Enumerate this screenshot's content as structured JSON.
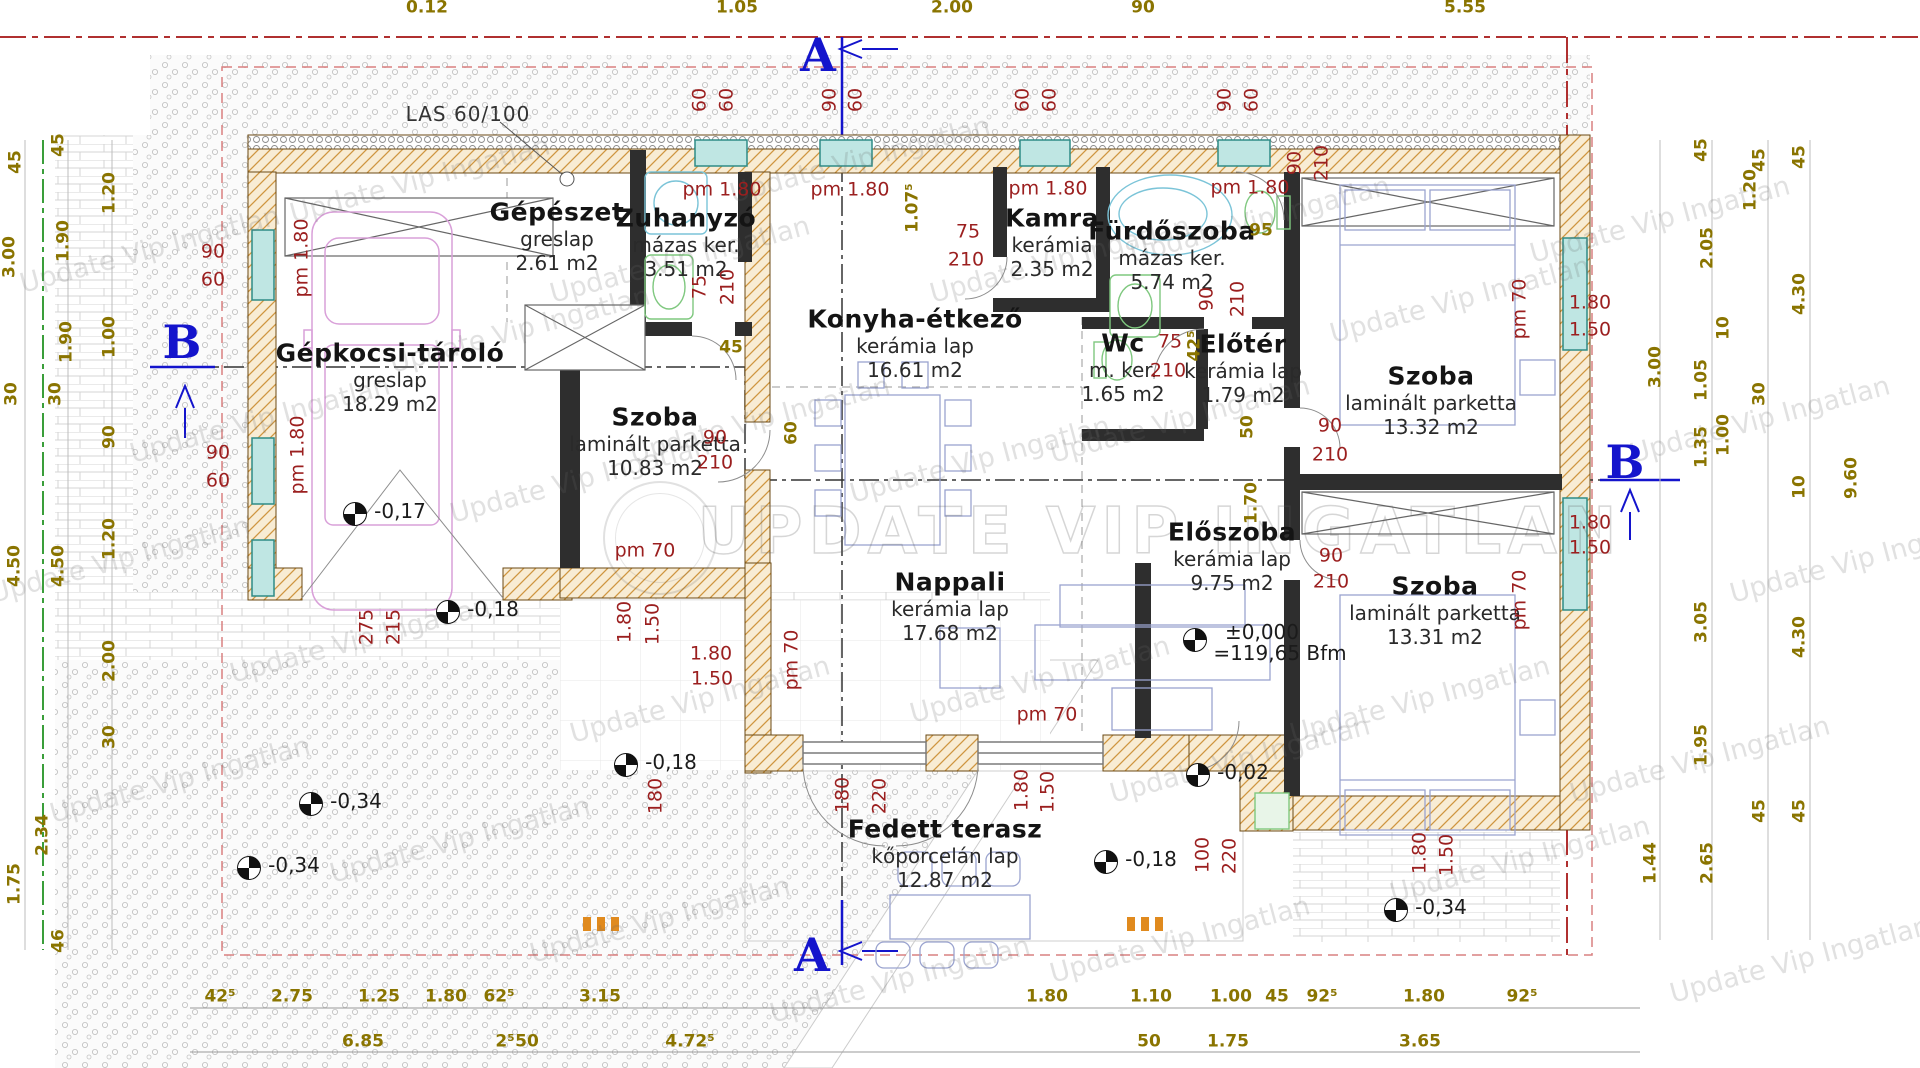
{
  "watermark": {
    "tile": "Update Vip Ingatlan",
    "big": "UPDATE VIP INGATLAN"
  },
  "section_markers": {
    "a": "A",
    "b": "B"
  },
  "beam_note": "LAS 60/100",
  "zero_level": {
    "line1": "±0,000",
    "line2": "=119,65 Bfm",
    "x": 1262,
    "y": 632
  },
  "colors": {
    "dim_red": "#9b1f1f",
    "dim_olive": "#8a7400",
    "section_blue": "#1414cc",
    "wall_tan": "#f8ecd4",
    "wall_hatch": "#cf9640",
    "window_teal": "#4da5a0",
    "boundary_red": "#b03030",
    "boundary_green": "#3a9e3a"
  },
  "rooms": [
    {
      "name": "Gépészet",
      "floor": "greslap",
      "area": "2.61 m2",
      "x": 557,
      "y": 212
    },
    {
      "name": "Zuhanyzó",
      "floor": "mázas ker.",
      "area": "3.51 m2",
      "x": 686,
      "y": 218
    },
    {
      "name": "Kamra",
      "floor": "kerámia",
      "area": "2.35 m2",
      "x": 1052,
      "y": 218
    },
    {
      "name": "Fürdőszoba",
      "floor": "mázas ker.",
      "area": "5.74 m2",
      "x": 1172,
      "y": 231
    },
    {
      "name": "Gépkocsi-tároló",
      "floor": "greslap",
      "area": "18.29 m2",
      "x": 390,
      "y": 353
    },
    {
      "name": "Szoba",
      "floor": "laminált parketta",
      "area": "10.83 m2",
      "x": 655,
      "y": 417
    },
    {
      "name": "Konyha-étkező",
      "floor": "kerámia lap",
      "area": "16.61 m2",
      "x": 915,
      "y": 319
    },
    {
      "name": "Wc",
      "floor": "m. ker.",
      "area": "1.65 m2",
      "x": 1123,
      "y": 343
    },
    {
      "name": "Előtér",
      "floor": "kerámia lap",
      "area": "1.79 m2",
      "x": 1243,
      "y": 344
    },
    {
      "name": "Szoba",
      "floor": "laminált parketta",
      "area": "13.32 m2",
      "x": 1431,
      "y": 376
    },
    {
      "name": "Nappali",
      "floor": "kerámia lap",
      "area": "17.68 m2",
      "x": 950,
      "y": 582
    },
    {
      "name": "Előszoba",
      "floor": "kerámia lap",
      "area": "9.75 m2",
      "x": 1232,
      "y": 532
    },
    {
      "name": "Szoba",
      "floor": "laminált parketta",
      "area": "13.31 m2",
      "x": 1435,
      "y": 586
    },
    {
      "name": "Fedett terasz",
      "floor": "kőporcelán lap",
      "area": "12.87 m2",
      "x": 945,
      "y": 829
    }
  ],
  "red_labels": [
    {
      "t": "pm 1.80",
      "x": 302,
      "y": 258,
      "r": 1
    },
    {
      "t": "90",
      "x": 213,
      "y": 252
    },
    {
      "t": "60",
      "x": 213,
      "y": 280
    },
    {
      "t": "pm 1.80",
      "x": 298,
      "y": 455,
      "r": 1
    },
    {
      "t": "90",
      "x": 218,
      "y": 453
    },
    {
      "t": "60",
      "x": 218,
      "y": 481
    },
    {
      "t": "60",
      "x": 700,
      "y": 100,
      "r": 1
    },
    {
      "t": "60",
      "x": 727,
      "y": 100,
      "r": 1
    },
    {
      "t": "90",
      "x": 830,
      "y": 100,
      "r": 1
    },
    {
      "t": "60",
      "x": 856,
      "y": 100,
      "r": 1
    },
    {
      "t": "60",
      "x": 1023,
      "y": 100,
      "r": 1
    },
    {
      "t": "60",
      "x": 1050,
      "y": 100,
      "r": 1
    },
    {
      "t": "90",
      "x": 1225,
      "y": 100,
      "r": 1
    },
    {
      "t": "60",
      "x": 1252,
      "y": 100,
      "r": 1
    },
    {
      "t": "pm 1.80",
      "x": 722,
      "y": 190
    },
    {
      "t": "pm 1.80",
      "x": 850,
      "y": 190
    },
    {
      "t": "pm 1.80",
      "x": 1048,
      "y": 189
    },
    {
      "t": "pm 1.80",
      "x": 1250,
      "y": 188
    },
    {
      "t": "75",
      "x": 968,
      "y": 232
    },
    {
      "t": "210",
      "x": 966,
      "y": 260
    },
    {
      "t": "75",
      "x": 700,
      "y": 287,
      "r": 1
    },
    {
      "t": "210",
      "x": 728,
      "y": 287,
      "r": 1
    },
    {
      "t": "90",
      "x": 1207,
      "y": 299,
      "r": 1
    },
    {
      "t": "210",
      "x": 1238,
      "y": 299,
      "r": 1
    },
    {
      "t": "75",
      "x": 1170,
      "y": 342
    },
    {
      "t": "210",
      "x": 1168,
      "y": 371
    },
    {
      "t": "90",
      "x": 1295,
      "y": 163,
      "r": 1
    },
    {
      "t": "210",
      "x": 1322,
      "y": 163,
      "r": 1
    },
    {
      "t": "90",
      "x": 1330,
      "y": 426
    },
    {
      "t": "210",
      "x": 1330,
      "y": 455
    },
    {
      "t": "90",
      "x": 715,
      "y": 438
    },
    {
      "t": "210",
      "x": 715,
      "y": 463
    },
    {
      "t": "90",
      "x": 1331,
      "y": 556
    },
    {
      "t": "210",
      "x": 1331,
      "y": 582
    },
    {
      "t": "275",
      "x": 367,
      "y": 627,
      "r": 1
    },
    {
      "t": "215",
      "x": 394,
      "y": 627,
      "r": 1
    },
    {
      "t": "1.80",
      "x": 625,
      "y": 622,
      "r": 1
    },
    {
      "t": "1.50",
      "x": 653,
      "y": 624,
      "r": 1
    },
    {
      "t": "1.80",
      "x": 711,
      "y": 654
    },
    {
      "t": "1.50",
      "x": 712,
      "y": 679
    },
    {
      "t": "pm 70",
      "x": 792,
      "y": 660,
      "r": 1
    },
    {
      "t": "pm 70",
      "x": 1047,
      "y": 715
    },
    {
      "t": "pm 70",
      "x": 645,
      "y": 551
    },
    {
      "t": "pm 70",
      "x": 1520,
      "y": 309,
      "r": 1
    },
    {
      "t": "pm 70",
      "x": 1520,
      "y": 600,
      "r": 1
    },
    {
      "t": "1.80",
      "x": 1590,
      "y": 303
    },
    {
      "t": "1.50",
      "x": 1590,
      "y": 330
    },
    {
      "t": "1.80",
      "x": 1590,
      "y": 523
    },
    {
      "t": "1.50",
      "x": 1590,
      "y": 548
    },
    {
      "t": "180",
      "x": 843,
      "y": 795,
      "r": 1
    },
    {
      "t": "220",
      "x": 880,
      "y": 796,
      "r": 1
    },
    {
      "t": "1.80",
      "x": 1022,
      "y": 790,
      "r": 1
    },
    {
      "t": "1.50",
      "x": 1048,
      "y": 792,
      "r": 1
    },
    {
      "t": "100",
      "x": 1203,
      "y": 855,
      "r": 1
    },
    {
      "t": "220",
      "x": 1230,
      "y": 856,
      "r": 1
    },
    {
      "t": "1.80",
      "x": 1420,
      "y": 853,
      "r": 1
    },
    {
      "t": "1.50",
      "x": 1447,
      "y": 855,
      "r": 1
    },
    {
      "t": "180",
      "x": 656,
      "y": 796,
      "r": 1
    }
  ],
  "yellow_labels": [
    {
      "t": "1.07⁵",
      "x": 913,
      "y": 208,
      "r": 1
    },
    {
      "t": "95",
      "x": 1261,
      "y": 231
    },
    {
      "t": "45",
      "x": 731,
      "y": 348
    },
    {
      "t": "60",
      "x": 792,
      "y": 433,
      "r": 1
    },
    {
      "t": "42⁵",
      "x": 1195,
      "y": 346,
      "r": 1
    },
    {
      "t": "50",
      "x": 1248,
      "y": 427,
      "r": 1
    },
    {
      "t": "1.70",
      "x": 1252,
      "y": 503,
      "r": 1
    }
  ],
  "dims": {
    "top": [
      {
        "t": "0.12",
        "x": 427
      },
      {
        "t": "1.05",
        "x": 737
      },
      {
        "t": "2.00",
        "x": 952
      },
      {
        "t": "90",
        "x": 1143
      },
      {
        "t": "5.55",
        "x": 1465
      }
    ],
    "bottom_row1": [
      {
        "t": "42⁵",
        "x": 220
      },
      {
        "t": "2.75",
        "x": 292
      },
      {
        "t": "1.25",
        "x": 379
      },
      {
        "t": "1.80",
        "x": 446
      },
      {
        "t": "62⁵",
        "x": 499
      },
      {
        "t": "3.15",
        "x": 600
      },
      {
        "t": "1.80",
        "x": 1047
      },
      {
        "t": "1.10",
        "x": 1151
      },
      {
        "t": "1.00",
        "x": 1231
      },
      {
        "t": "45",
        "x": 1277
      },
      {
        "t": "92⁵",
        "x": 1322
      },
      {
        "t": "1.80",
        "x": 1424
      },
      {
        "t": "92⁵",
        "x": 1522
      }
    ],
    "bottom_row2": [
      {
        "t": "6.85",
        "x": 363
      },
      {
        "t": "2⁵",
        "x": 505
      },
      {
        "t": "50",
        "x": 527
      },
      {
        "t": "4.72⁵",
        "x": 690
      },
      {
        "t": "50",
        "x": 1149
      },
      {
        "t": "1.75",
        "x": 1228
      },
      {
        "t": "3.65",
        "x": 1420
      }
    ],
    "left": [
      {
        "t": "45",
        "x": 59,
        "y": 145
      },
      {
        "t": "45",
        "x": 16,
        "y": 162
      },
      {
        "t": "1.20",
        "x": 110,
        "y": 193
      },
      {
        "t": "1.90",
        "x": 64,
        "y": 241
      },
      {
        "t": "3.00",
        "x": 10,
        "y": 257
      },
      {
        "t": "1.00",
        "x": 110,
        "y": 337
      },
      {
        "t": "1.90",
        "x": 67,
        "y": 342
      },
      {
        "t": "30",
        "x": 12,
        "y": 394
      },
      {
        "t": "30",
        "x": 56,
        "y": 394
      },
      {
        "t": "90",
        "x": 110,
        "y": 437
      },
      {
        "t": "1.20",
        "x": 110,
        "y": 539
      },
      {
        "t": "4.50",
        "x": 15,
        "y": 566
      },
      {
        "t": "4.50",
        "x": 59,
        "y": 566
      },
      {
        "t": "2.00",
        "x": 110,
        "y": 661
      },
      {
        "t": "30",
        "x": 110,
        "y": 737
      },
      {
        "t": "2.34",
        "x": 43,
        "y": 835
      },
      {
        "t": "1.75",
        "x": 15,
        "y": 884
      },
      {
        "t": "46",
        "x": 59,
        "y": 941
      }
    ],
    "right": [
      {
        "t": "45",
        "x": 1702,
        "y": 150
      },
      {
        "t": "45",
        "x": 1760,
        "y": 160
      },
      {
        "t": "45",
        "x": 1800,
        "y": 157
      },
      {
        "t": "1.20",
        "x": 1751,
        "y": 190
      },
      {
        "t": "2.05",
        "x": 1708,
        "y": 248
      },
      {
        "t": "10",
        "x": 1724,
        "y": 328
      },
      {
        "t": "4.30",
        "x": 1800,
        "y": 294
      },
      {
        "t": "3.00",
        "x": 1656,
        "y": 367
      },
      {
        "t": "1.05",
        "x": 1702,
        "y": 380
      },
      {
        "t": "30",
        "x": 1760,
        "y": 394
      },
      {
        "t": "1.35",
        "x": 1702,
        "y": 447
      },
      {
        "t": "1.00",
        "x": 1724,
        "y": 435
      },
      {
        "t": "10",
        "x": 1800,
        "y": 487
      },
      {
        "t": "9.60",
        "x": 1852,
        "y": 478
      },
      {
        "t": "3.05",
        "x": 1702,
        "y": 622
      },
      {
        "t": "4.30",
        "x": 1800,
        "y": 637
      },
      {
        "t": "1.95",
        "x": 1702,
        "y": 745
      },
      {
        "t": "45",
        "x": 1760,
        "y": 811
      },
      {
        "t": "45",
        "x": 1800,
        "y": 811
      },
      {
        "t": "1.44",
        "x": 1651,
        "y": 863
      },
      {
        "t": "2.65",
        "x": 1708,
        "y": 863
      }
    ]
  },
  "elevations": [
    {
      "t": "-0,17",
      "x": 355,
      "y": 514
    },
    {
      "t": "-0,18",
      "x": 448,
      "y": 612
    },
    {
      "t": "-0,18",
      "x": 626,
      "y": 765
    },
    {
      "t": "-0,34",
      "x": 311,
      "y": 804
    },
    {
      "t": "-0,34",
      "x": 249,
      "y": 868
    },
    {
      "t": "-0,18",
      "x": 1106,
      "y": 862
    },
    {
      "t": "-0,02",
      "x": 1198,
      "y": 775
    },
    {
      "t": "-0,34",
      "x": 1396,
      "y": 910
    }
  ]
}
